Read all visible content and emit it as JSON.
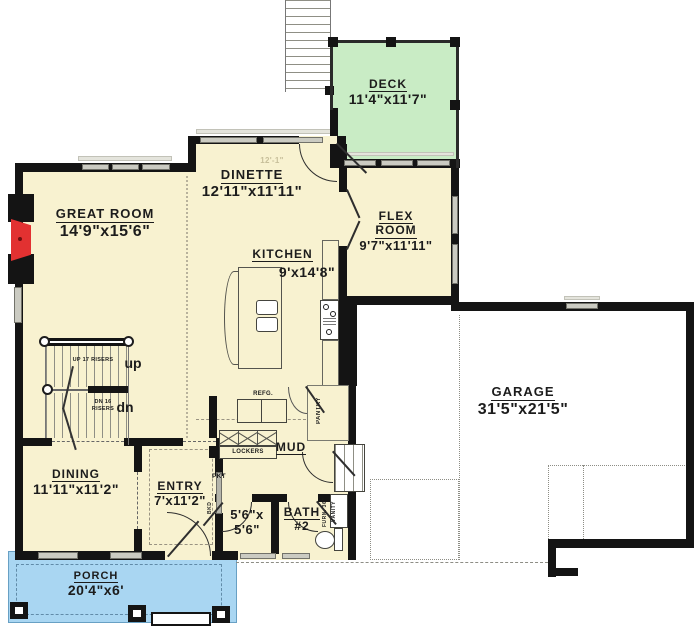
{
  "colors": {
    "wall": "#141414",
    "room_fill": "#f8f2d0",
    "deck_fill": "#c9ecc5",
    "porch_fill": "#a9d6f2",
    "garage_fill": "#ffffff",
    "window": "#cbcbc2",
    "fireplace": "#e23131"
  },
  "rooms": {
    "deck": {
      "name": "DECK",
      "dims": "11'4\"x11'7\""
    },
    "great_room": {
      "name": "GREAT ROOM",
      "dims": "14'9\"x15'6\""
    },
    "dinette": {
      "name": "DINETTE",
      "dims": "12'11\"x11'11\""
    },
    "flex": {
      "name1": "FLEX",
      "name2": "ROOM",
      "dims": "9'7\"x11'11\""
    },
    "kitchen": {
      "name": "KITCHEN",
      "dims": "9'x14'8\""
    },
    "garage": {
      "name": "GARAGE",
      "dims": "31'5\"x21'5\""
    },
    "dining": {
      "name": "DINING",
      "dims": "11'11\"x11'2\""
    },
    "entry": {
      "name": "ENTRY",
      "dims": "7'x11'2\""
    },
    "closet": {
      "dims1": "5'6\"x",
      "dims2": "5'6\""
    },
    "bath2": {
      "name1": "BATH",
      "name2": "#2"
    },
    "mud": {
      "name": "MUD"
    },
    "porch": {
      "name": "PORCH",
      "dims": "20'4\"x6'"
    }
  },
  "stairs": {
    "up_label": "up",
    "up_note": "UP 17 RISERS",
    "dn_label": "dn",
    "dn_note_1": "DN 16",
    "dn_note_2": "RISERS"
  },
  "fixtures": {
    "refrigerator": "REFG.",
    "pantry": "PANTRY",
    "lockers": "LOCKERS",
    "pocket_door": "PKT",
    "bkd": "BKD",
    "furnace": "FURN. 36\"",
    "vanity": "VANITY"
  },
  "dim_note": "12'-1\""
}
